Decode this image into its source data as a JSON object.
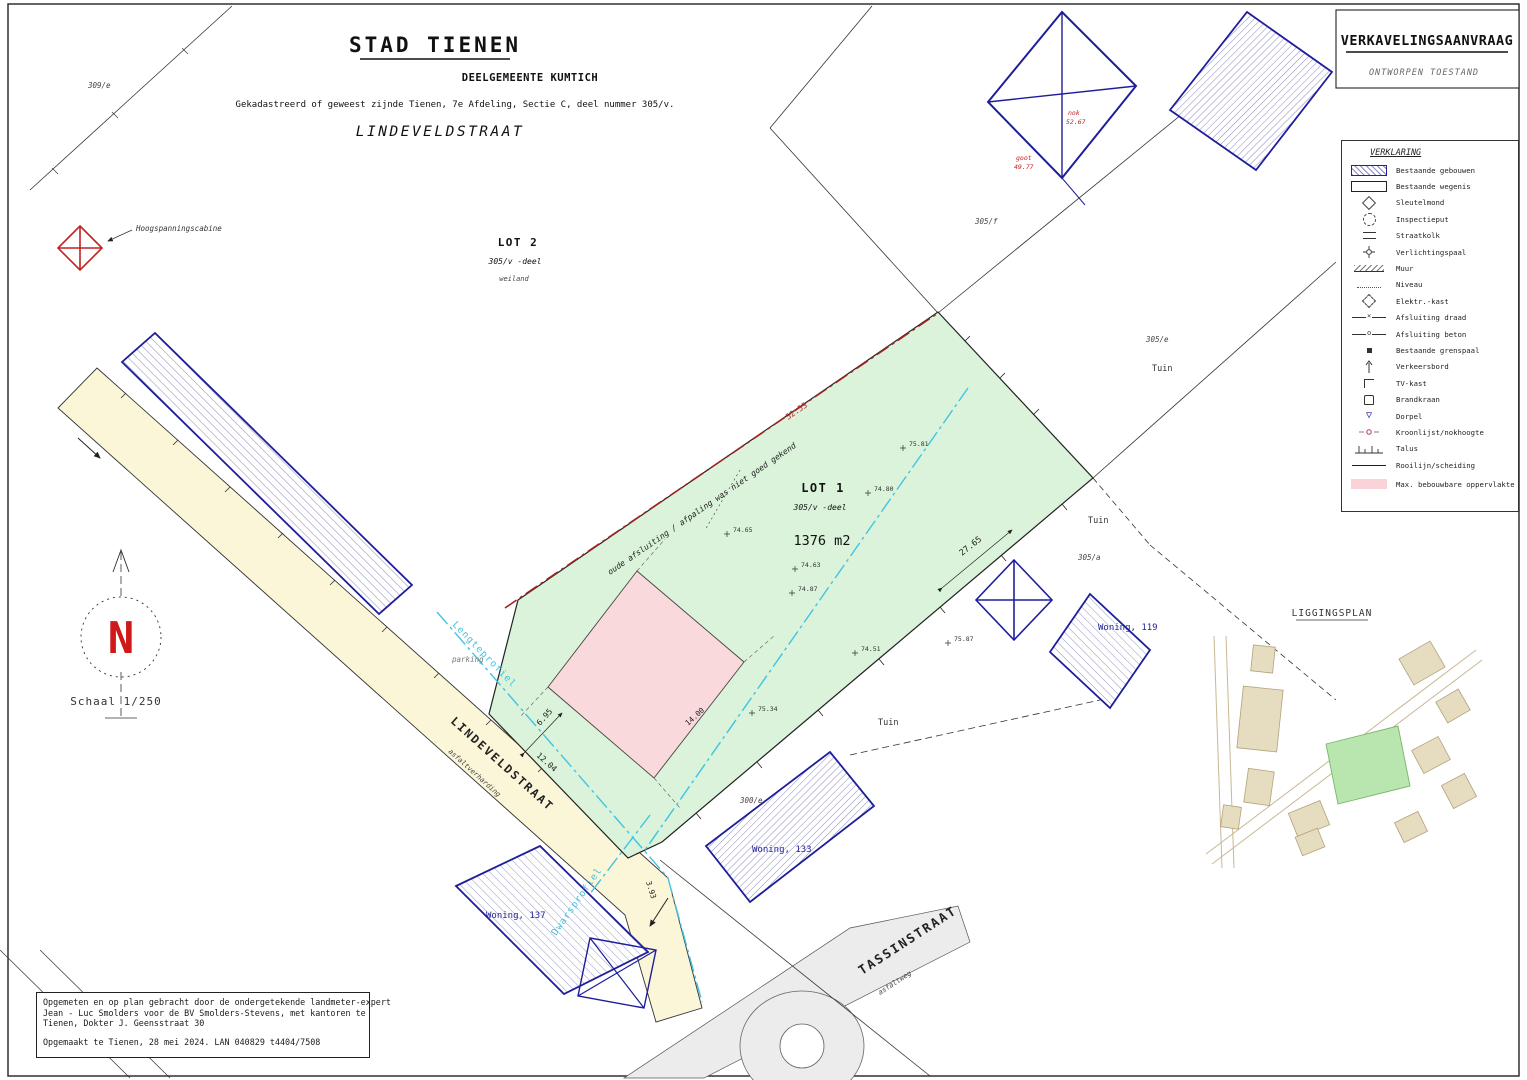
{
  "header": {
    "city": "STAD TIENEN",
    "municipality": "DEELGEMEENTE KUMTICH",
    "cadastral": "Gekadastreerd of geweest zijnde Tienen, 7e Afdeling, Sectie C, deel nummer 305/v.",
    "street": "LINDEVELDSTRAAT"
  },
  "title_block": {
    "title": "VERKAVELINGSAANVRAAG",
    "subtitle": "ONTWORPEN TOESTAND"
  },
  "legend": {
    "title": "VERKLARING",
    "items": [
      {
        "id": "bestaande-gebouwen-swatch",
        "label": "Bestaande gebouwen"
      },
      {
        "id": "bestaande-wegenis-swatch",
        "label": "Bestaande wegenis"
      },
      {
        "id": "sleutelmond-icon",
        "label": "Sleutelmond"
      },
      {
        "id": "inspectieput-icon",
        "label": "Inspectieput"
      },
      {
        "id": "straatkolk-icon",
        "label": "Straatkolk"
      },
      {
        "id": "verlichtingspaal-icon",
        "label": "Verlichtingspaal"
      },
      {
        "id": "muur-icon",
        "label": "Muur"
      },
      {
        "id": "niveau-icon",
        "label": "Niveau"
      },
      {
        "id": "elektr-kast-icon",
        "label": "Elektr.-kast"
      },
      {
        "id": "afsluiting-draad-icon",
        "label": "Afsluiting draad"
      },
      {
        "id": "afsluiting-beton-icon",
        "label": "Afsluiting beton"
      },
      {
        "id": "grenspaal-icon",
        "label": "Bestaande grenspaal"
      },
      {
        "id": "verkeersbord-icon",
        "label": "Verkeersbord"
      },
      {
        "id": "tv-kast-icon",
        "label": "TV-kast"
      },
      {
        "id": "brandkraan-icon",
        "label": "Brandkraan"
      },
      {
        "id": "dorpel-icon",
        "label": "Dorpel"
      },
      {
        "id": "kroonlijst-nokhoogte-icon",
        "label": "Kroonlijst/nokhoogte"
      },
      {
        "id": "talus-icon",
        "label": "Talus"
      },
      {
        "id": "rooilijn-icon",
        "label": "Rooilijn/scheiding"
      },
      {
        "id": "max-bebouwbaar-swatch",
        "label": "Max. bebouwbare oppervlakte"
      }
    ]
  },
  "plan": {
    "lot1": {
      "name": "LOT 1",
      "parcel": "305/v -deel",
      "area": "1376 m2"
    },
    "lot2": {
      "name": "LOT 2",
      "parcel": "305/v -deel",
      "note": "weiland"
    },
    "streets": {
      "lindeveldstraat": "LINDEVELDSTRAAT",
      "lindeveld_sub": "asfaltverharding",
      "tassinstraat": "TASSINSTRAAT",
      "tassin_sub": "asfaltweg"
    },
    "labels": {
      "tuin": "Tuin",
      "woning119": "Woning, 119",
      "woning133": "Woning, 133",
      "woning137": "Woning, 137",
      "hoogspanning": "Hoogspanningscabine",
      "lengteprofiel": "Lengteprofiel",
      "dwarsprofiel": "Dwarsprofiel",
      "parking": "parking",
      "boundary_note": "oude afsluiting / afpaling was niet goed gekend"
    },
    "parcels": [
      "309/e",
      "305/f",
      "305/e",
      "305/a",
      "300/e"
    ],
    "measurements": {
      "m2765": "27.65",
      "m1204": "12.04",
      "m695": "6.95",
      "m5253": "52.53",
      "m393": "3.93",
      "m1400": "14.00"
    },
    "spot_heights": [
      "74.65",
      "74.63",
      "74.87",
      "74.51",
      "75.34",
      "75.81",
      "74.80",
      "75.87"
    ],
    "levels": {
      "nok": "nok",
      "nok_v": "52.67",
      "goot": "goot",
      "goot_v": "49.77"
    },
    "north": {
      "n": "N",
      "scale": "Schaal 1/250"
    },
    "liggingsplan_title": "LIGGINGSPLAN"
  },
  "footer": {
    "lines": [
      "Opgemeten en op plan gebracht door de ondergetekende landmeter-expert",
      "Jean - Luc Smolders voor de BV Smolders-Stevens, met kantoren te",
      "Tienen, Dokter J. Geensstraat 30",
      "Opgemaakt te Tienen, 28 mei 2024.  LAN 040829   t4404/7508"
    ]
  },
  "colors": {
    "navy": "#1e1e9c",
    "red": "#c22222",
    "dark_red_boundary": "#a22222",
    "cyan": "#41c3e3",
    "lot_green": "#daf3da",
    "zone_pink": "#f9d9dc",
    "road_yellow": "#fcf6d9",
    "road_gray": "#ececec",
    "minimap_tan": "#e6dcc0",
    "minimap_green": "#b9e6ae"
  }
}
